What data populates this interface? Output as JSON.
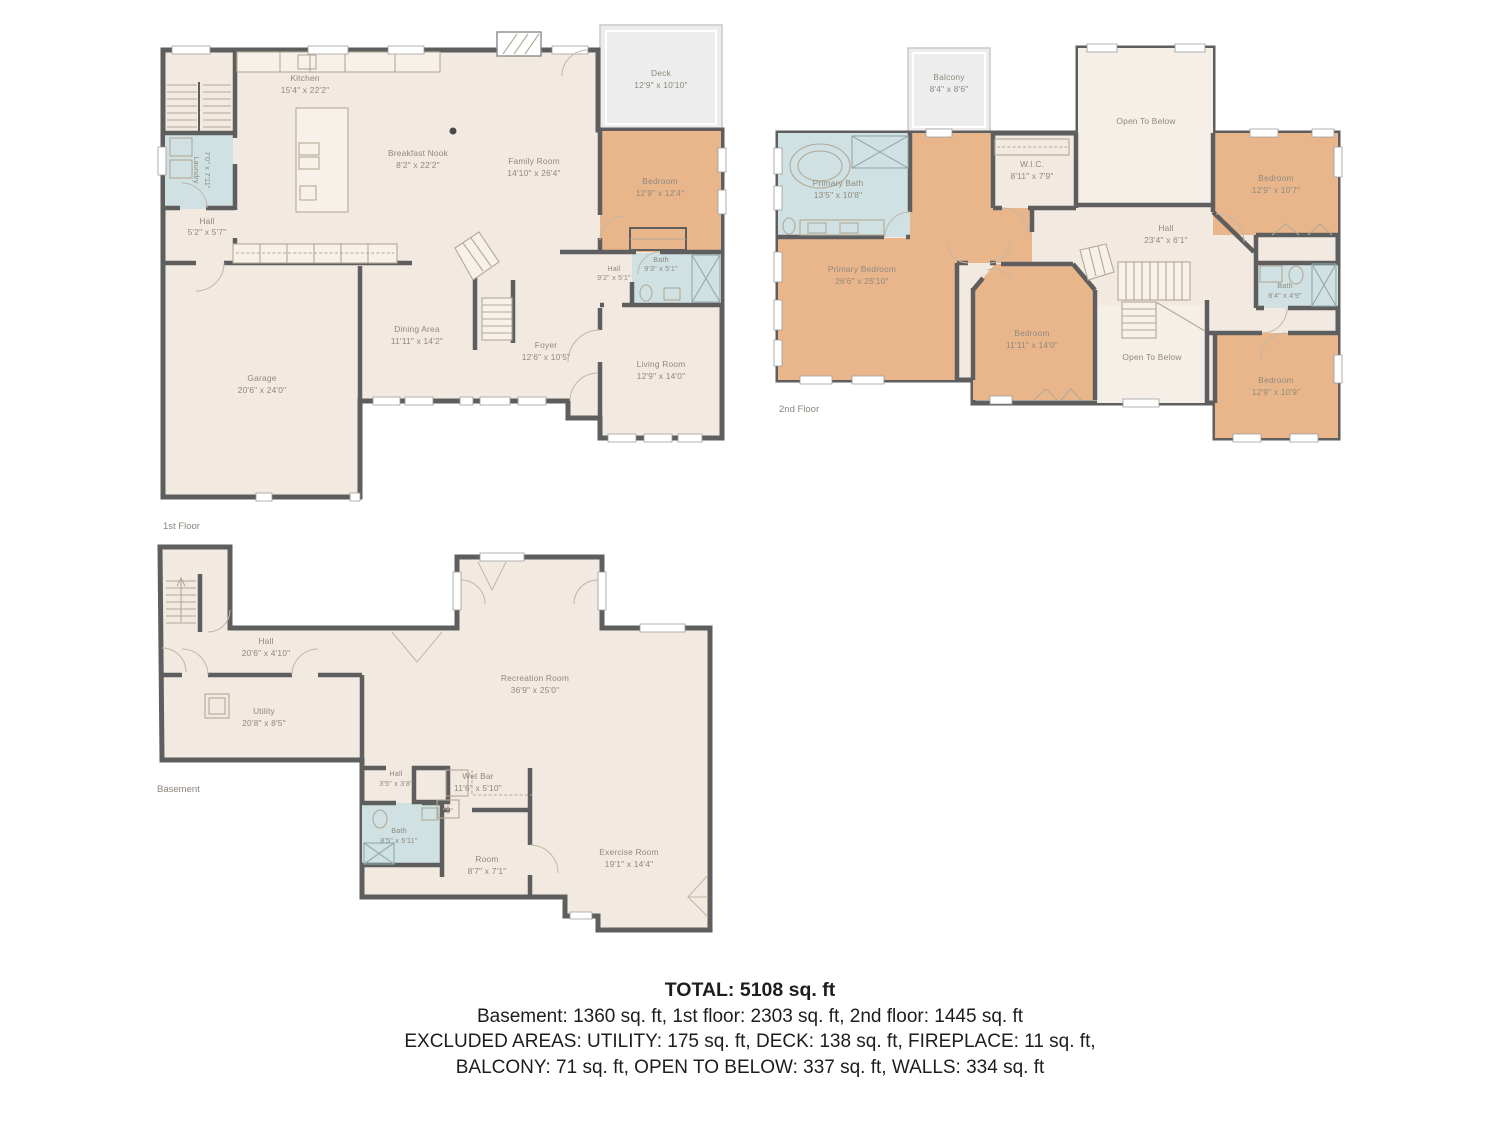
{
  "colors": {
    "wall": "#5e5e5e",
    "floor": "#f2e9e1",
    "floor_light": "#f5efe8",
    "bedroom_accent": "#e9b68c",
    "bath_accent": "#cfe1e3",
    "deck": "#ededed",
    "label_text": "#8f897e",
    "summary_text": "#1d1d1d"
  },
  "floors": [
    {
      "label": "1st Floor",
      "rooms": [
        {
          "name": "Kitchen",
          "dims": "15'4\" x 22'2\""
        },
        {
          "name": "Breakfast Nook",
          "dims": "8'2\" x 22'2\""
        },
        {
          "name": "Family Room",
          "dims": "14'10\" x 26'4\""
        },
        {
          "name": "Deck",
          "dims": "12'9\" x 10'10\""
        },
        {
          "name": "Bedroom",
          "dims": "12'9\" x 12'4\""
        },
        {
          "name": "Laundry",
          "dims": "7'0\" x 7'11\""
        },
        {
          "name": "Hall",
          "dims": "5'2\" x 5'7\""
        },
        {
          "name": "Bath",
          "dims": "9'3\" x 5'1\""
        },
        {
          "name": "Hall",
          "dims": "9'2\" x 5'1\""
        },
        {
          "name": "Dining Area",
          "dims": "11'11\" x 14'2\""
        },
        {
          "name": "Foyer",
          "dims": "12'6\" x 10'5\""
        },
        {
          "name": "Living Room",
          "dims": "12'9\" x 14'0\""
        },
        {
          "name": "Garage",
          "dims": "20'6\" x 24'0\""
        }
      ]
    },
    {
      "label": "2nd Floor",
      "rooms": [
        {
          "name": "Balcony",
          "dims": "8'4\" x 8'6\""
        },
        {
          "name": "Primary Bath",
          "dims": "13'5\" x 10'8\""
        },
        {
          "name": "W.I.C.",
          "dims": "8'11\" x 7'9\""
        },
        {
          "name": "Open To Below",
          "dims": ""
        },
        {
          "name": "Bedroom",
          "dims": "12'9\" x 10'7\""
        },
        {
          "name": "Hall",
          "dims": "23'4\" x 6'1\""
        },
        {
          "name": "Primary Bedroom",
          "dims": "26'6\" x 25'10\""
        },
        {
          "name": "Bath",
          "dims": "8'4\" x 4'9\""
        },
        {
          "name": "Bedroom",
          "dims": "11'11\" x 14'0\""
        },
        {
          "name": "Open To Below",
          "dims": ""
        },
        {
          "name": "Bedroom",
          "dims": "12'9\" x 10'9\""
        }
      ]
    },
    {
      "label": "Basement",
      "rooms": [
        {
          "name": "Hall",
          "dims": "20'6\" x 4'10\""
        },
        {
          "name": "Utility",
          "dims": "20'8\" x 8'5\""
        },
        {
          "name": "Recreation Room",
          "dims": "36'9\" x 25'0\""
        },
        {
          "name": "Hall",
          "dims": "3'5\" x 3'8\""
        },
        {
          "name": "Wet Bar",
          "dims": "11'6\" x 5'10\""
        },
        {
          "name": "Bath",
          "dims": "8'5\" x 5'11\""
        },
        {
          "name": "Room",
          "dims": "8'7\" x 7'1\""
        },
        {
          "name": "Exercise Room",
          "dims": "19'1\" x 14'4\""
        }
      ]
    }
  ],
  "summary": {
    "total": "TOTAL: 5108 sq. ft",
    "floors_line": "Basement: 1360 sq. ft, 1st floor: 2303 sq. ft, 2nd floor: 1445 sq. ft",
    "excluded_line1": "EXCLUDED AREAS: UTILITY: 175 sq. ft, DECK: 138 sq. ft, FIREPLACE: 11 sq. ft,",
    "excluded_line2": "BALCONY: 71 sq. ft, OPEN TO BELOW: 337 sq. ft, WALLS: 334 sq. ft"
  }
}
